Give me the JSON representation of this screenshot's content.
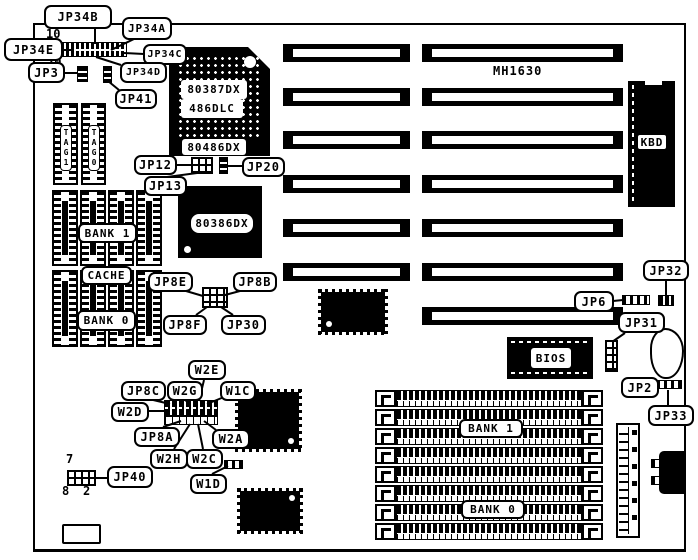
{
  "board": {
    "model": "MH1630"
  },
  "callouts": {
    "jp34b": "JP34B",
    "jp34a": "JP34A",
    "jp34e": "JP34E",
    "jp34c": "JP34C",
    "jp3": "JP3",
    "jp34d": "JP34D",
    "jp41": "JP41",
    "jp12": "JP12",
    "jp20": "JP20",
    "jp13": "JP13",
    "jp8e": "JP8E",
    "jp8b": "JP8B",
    "jp8f": "JP8F",
    "jp30": "JP30",
    "w2e": "W2E",
    "jp8c": "JP8C",
    "w2g": "W2G",
    "w1c": "W1C",
    "w2d": "W2D",
    "jp8a": "JP8A",
    "w2a": "W2A",
    "w2h": "W2H",
    "w2c": "W2C",
    "w1d": "W1D",
    "jp40": "JP40",
    "jp6": "JP6",
    "jp32": "JP32",
    "jp31": "JP31",
    "jp2": "JP2",
    "jp33": "JP33"
  },
  "chips": {
    "coprocessor_line1": "80387DX",
    "coprocessor_line2": "486DLC",
    "cpu_socket": "80486DX",
    "cpu": "80386DX",
    "bios": "BIOS",
    "keyboard_controller": "KBD",
    "tag1": "TAG1",
    "tag0": "TAG0"
  },
  "memory": {
    "cache_bank1": "BANK 1",
    "cache_label": "CACHE",
    "cache_bank0": "BANK 0",
    "simm_bank1": "BANK 1",
    "simm_bank0": "BANK 0"
  },
  "pin_markers": {
    "jp34_pin10": "10",
    "jp34_pin20": "20",
    "jp40_pin7": "7",
    "jp40_pin8": "8",
    "jp40_pin2": "2"
  },
  "colors": {
    "ink": "#000000",
    "paper": "#ffffff"
  }
}
